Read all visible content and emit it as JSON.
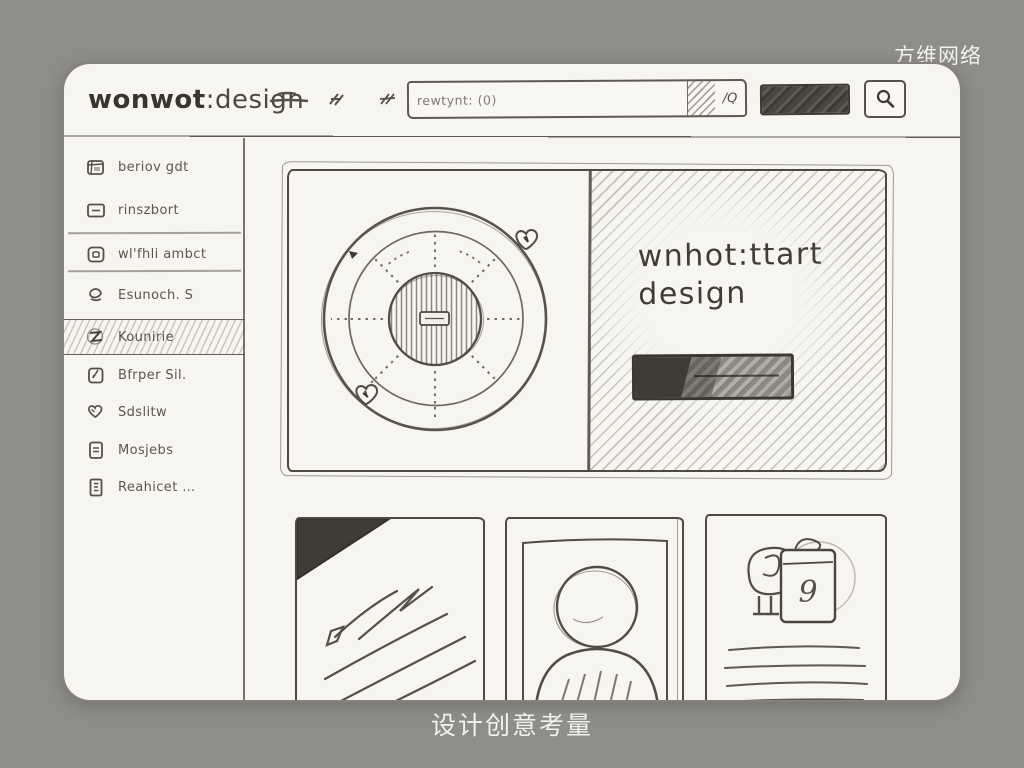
{
  "page": {
    "watermark": "方维网络",
    "caption": "设计创意考量"
  },
  "header": {
    "logo_bold": "wonwot",
    "logo_light": ":design",
    "search_placeholder": "rewtynt: (0)",
    "search_shortcut": "/Q"
  },
  "sidebar": {
    "items": [
      {
        "label": "beriov gdt",
        "icon": "cube-icon",
        "active": false
      },
      {
        "label": "rinszbort",
        "icon": "card-icon",
        "active": false
      },
      {
        "label": "wl'fhli ambct",
        "icon": "panel-icon",
        "active": false
      },
      {
        "label": "Esunoch. S",
        "icon": "cup-icon",
        "active": false
      },
      {
        "label": "Kounirie",
        "icon": "badge-icon",
        "active": true
      },
      {
        "label": "Bfrper Sil.",
        "icon": "pen-icon",
        "active": false
      },
      {
        "label": "Sdslitw",
        "icon": "heart-icon",
        "active": false
      },
      {
        "label": "Mosjebs",
        "icon": "doc-icon",
        "active": false
      },
      {
        "label": "Reahicet …",
        "icon": "file-icon",
        "active": false
      }
    ]
  },
  "hero": {
    "headline_line1": "wnhot:ttart",
    "headline_line2": "design"
  },
  "cards": {
    "gift_label": "9"
  },
  "colors": {
    "background": "#8e8d8a",
    "canvas": "#f6f5ef",
    "ink": "#4e4a43",
    "white_text": "#f3f2ee"
  }
}
